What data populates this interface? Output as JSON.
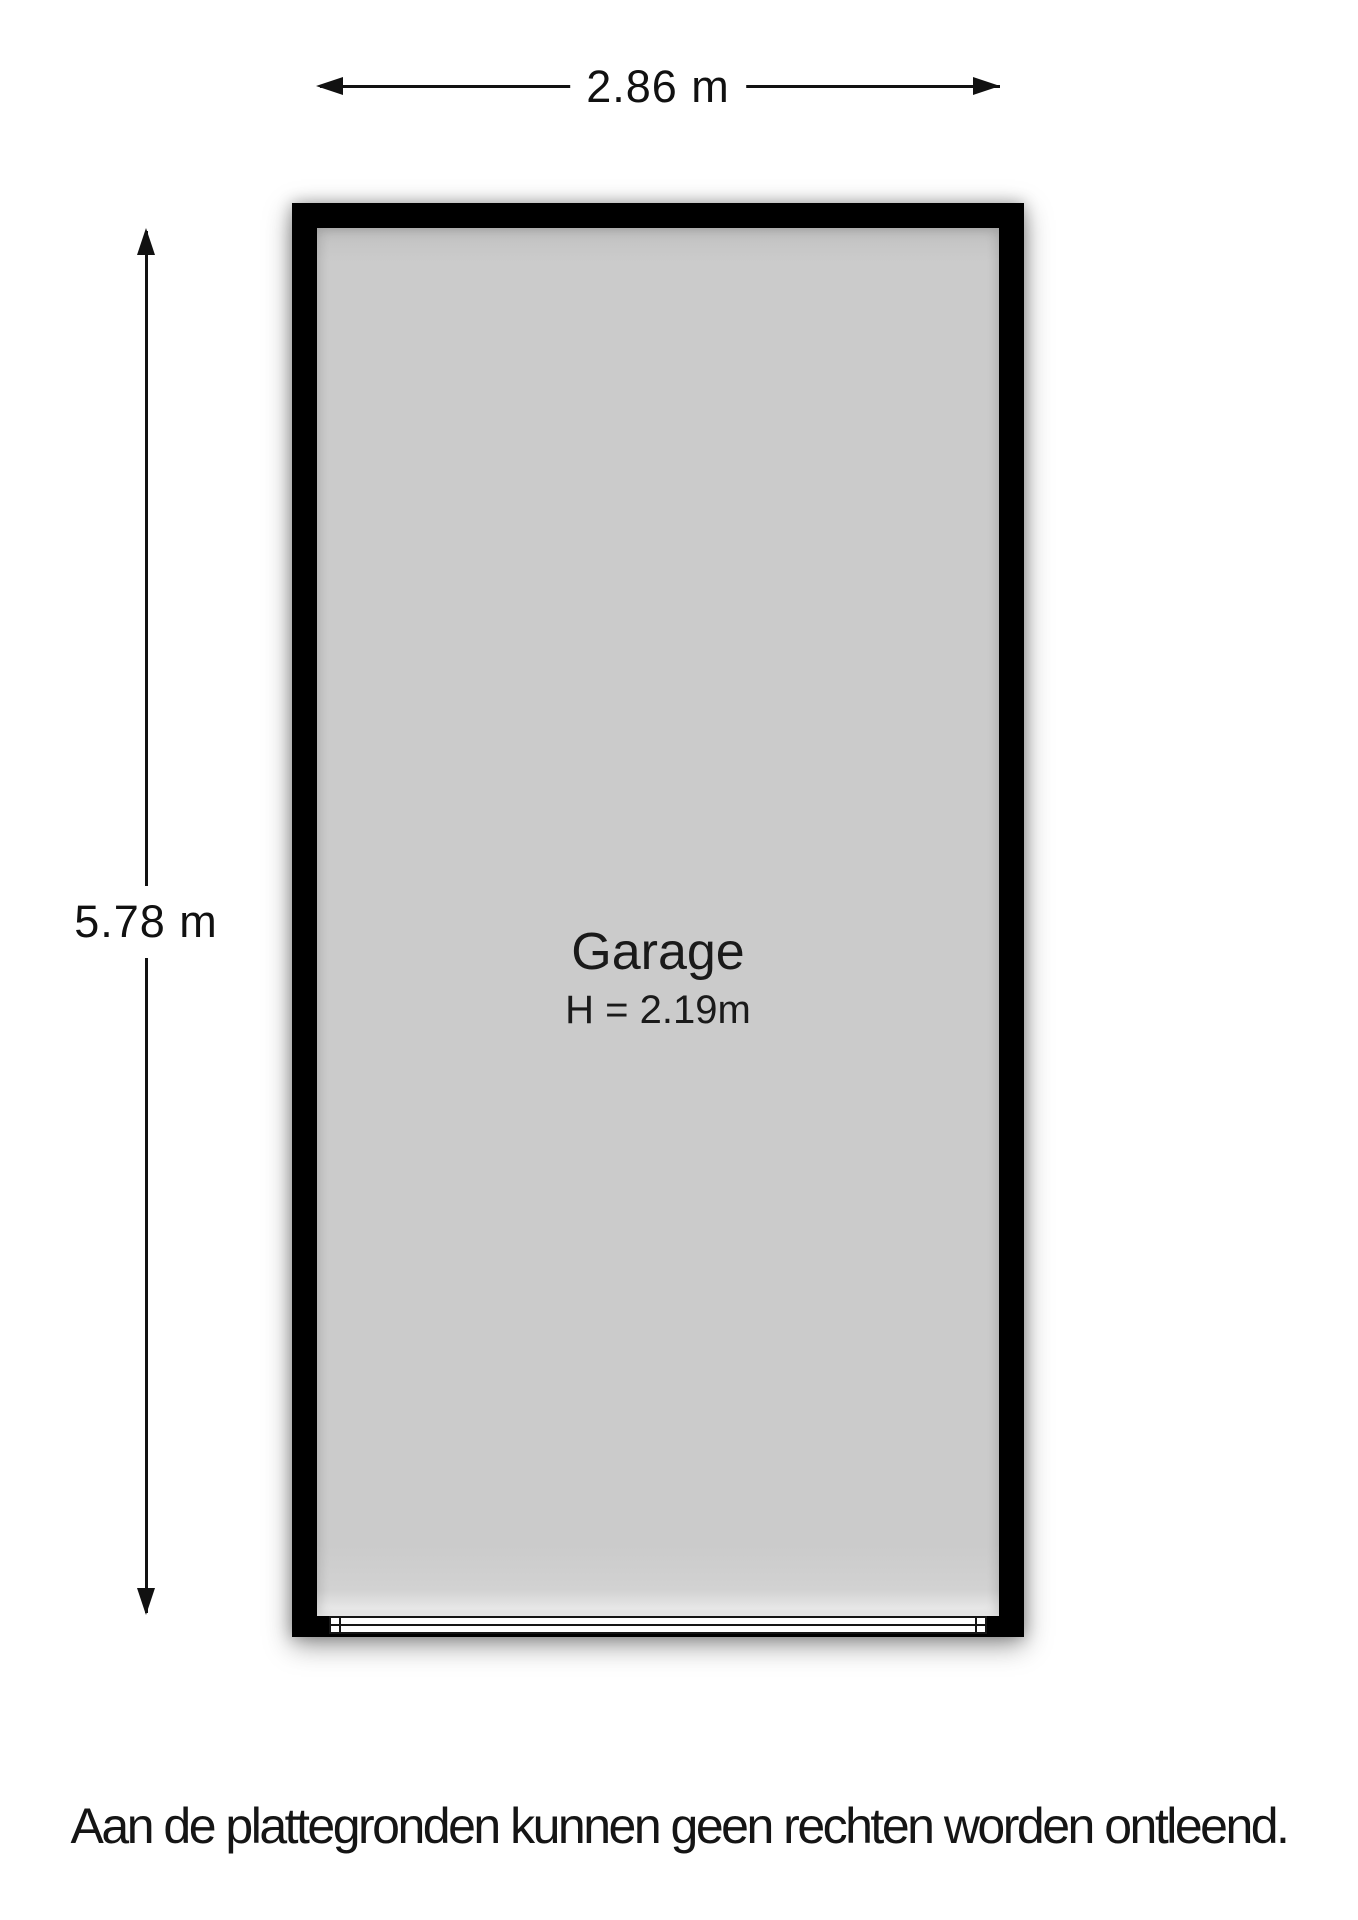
{
  "floorplan": {
    "room": {
      "name": "Garage",
      "ceiling_height": "H = 2.19m"
    },
    "dimensions": {
      "width": "2.86 m",
      "depth": "5.78 m"
    },
    "disclaimer": "Aan de plattegronden kunnen geen rechten worden ontleend.",
    "colors": {
      "wall": "#000000",
      "floor": "#cbcbcb",
      "background": "#ffffff",
      "line": "#111111"
    }
  }
}
